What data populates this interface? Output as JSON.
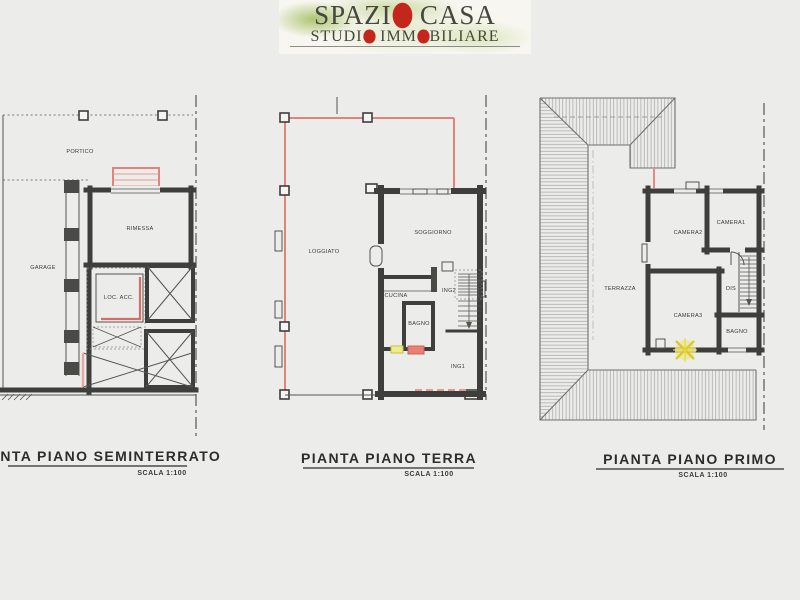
{
  "brand": {
    "l1_a": "SPAZI",
    "l1_b": "O",
    "l1_c": " CASA",
    "l2_a": "STUDI",
    "l2_b": "O",
    "l2_c": " IMM",
    "l2_d": "O",
    "l2_e": "BILIARE"
  },
  "plans": {
    "seminterrato": {
      "title": "PIANTA PIANO SEMINTERRATO",
      "scale": "SCALA 1:100",
      "rooms": {
        "portico": "PORTICO",
        "garage": "GARAGE",
        "rimessa": "RIMESSA",
        "loc_acc": "LOC.  ACC."
      }
    },
    "terra": {
      "title": "PIANTA PIANO TERRA",
      "scale": "SCALA 1:100",
      "rooms": {
        "loggiato": "LOGGIATO",
        "soggiorno": "SOGGIORNO",
        "cucina": "CUCINA",
        "bagno": "BAGNO",
        "ing2": "ING2",
        "ing1": "ING1"
      }
    },
    "primo": {
      "title": "PIANTA PIANO PRIMO",
      "scale": "SCALA 1:100",
      "rooms": {
        "terrazza": "TERRAZZA",
        "camera1": "CAMERA1",
        "camera2": "CAMERA2",
        "camera3": "CAMERA3",
        "dis": "DIS",
        "bagno": "BAGNO"
      }
    }
  },
  "colors": {
    "background": "#ececeb",
    "wall": "#3e3e3c",
    "line_red": "#e2837b",
    "highlight_yellow": "#eeea8e",
    "highlight_red": "#e88175",
    "logo_red": "#c5261b",
    "logo_green": "#b6ca87"
  }
}
